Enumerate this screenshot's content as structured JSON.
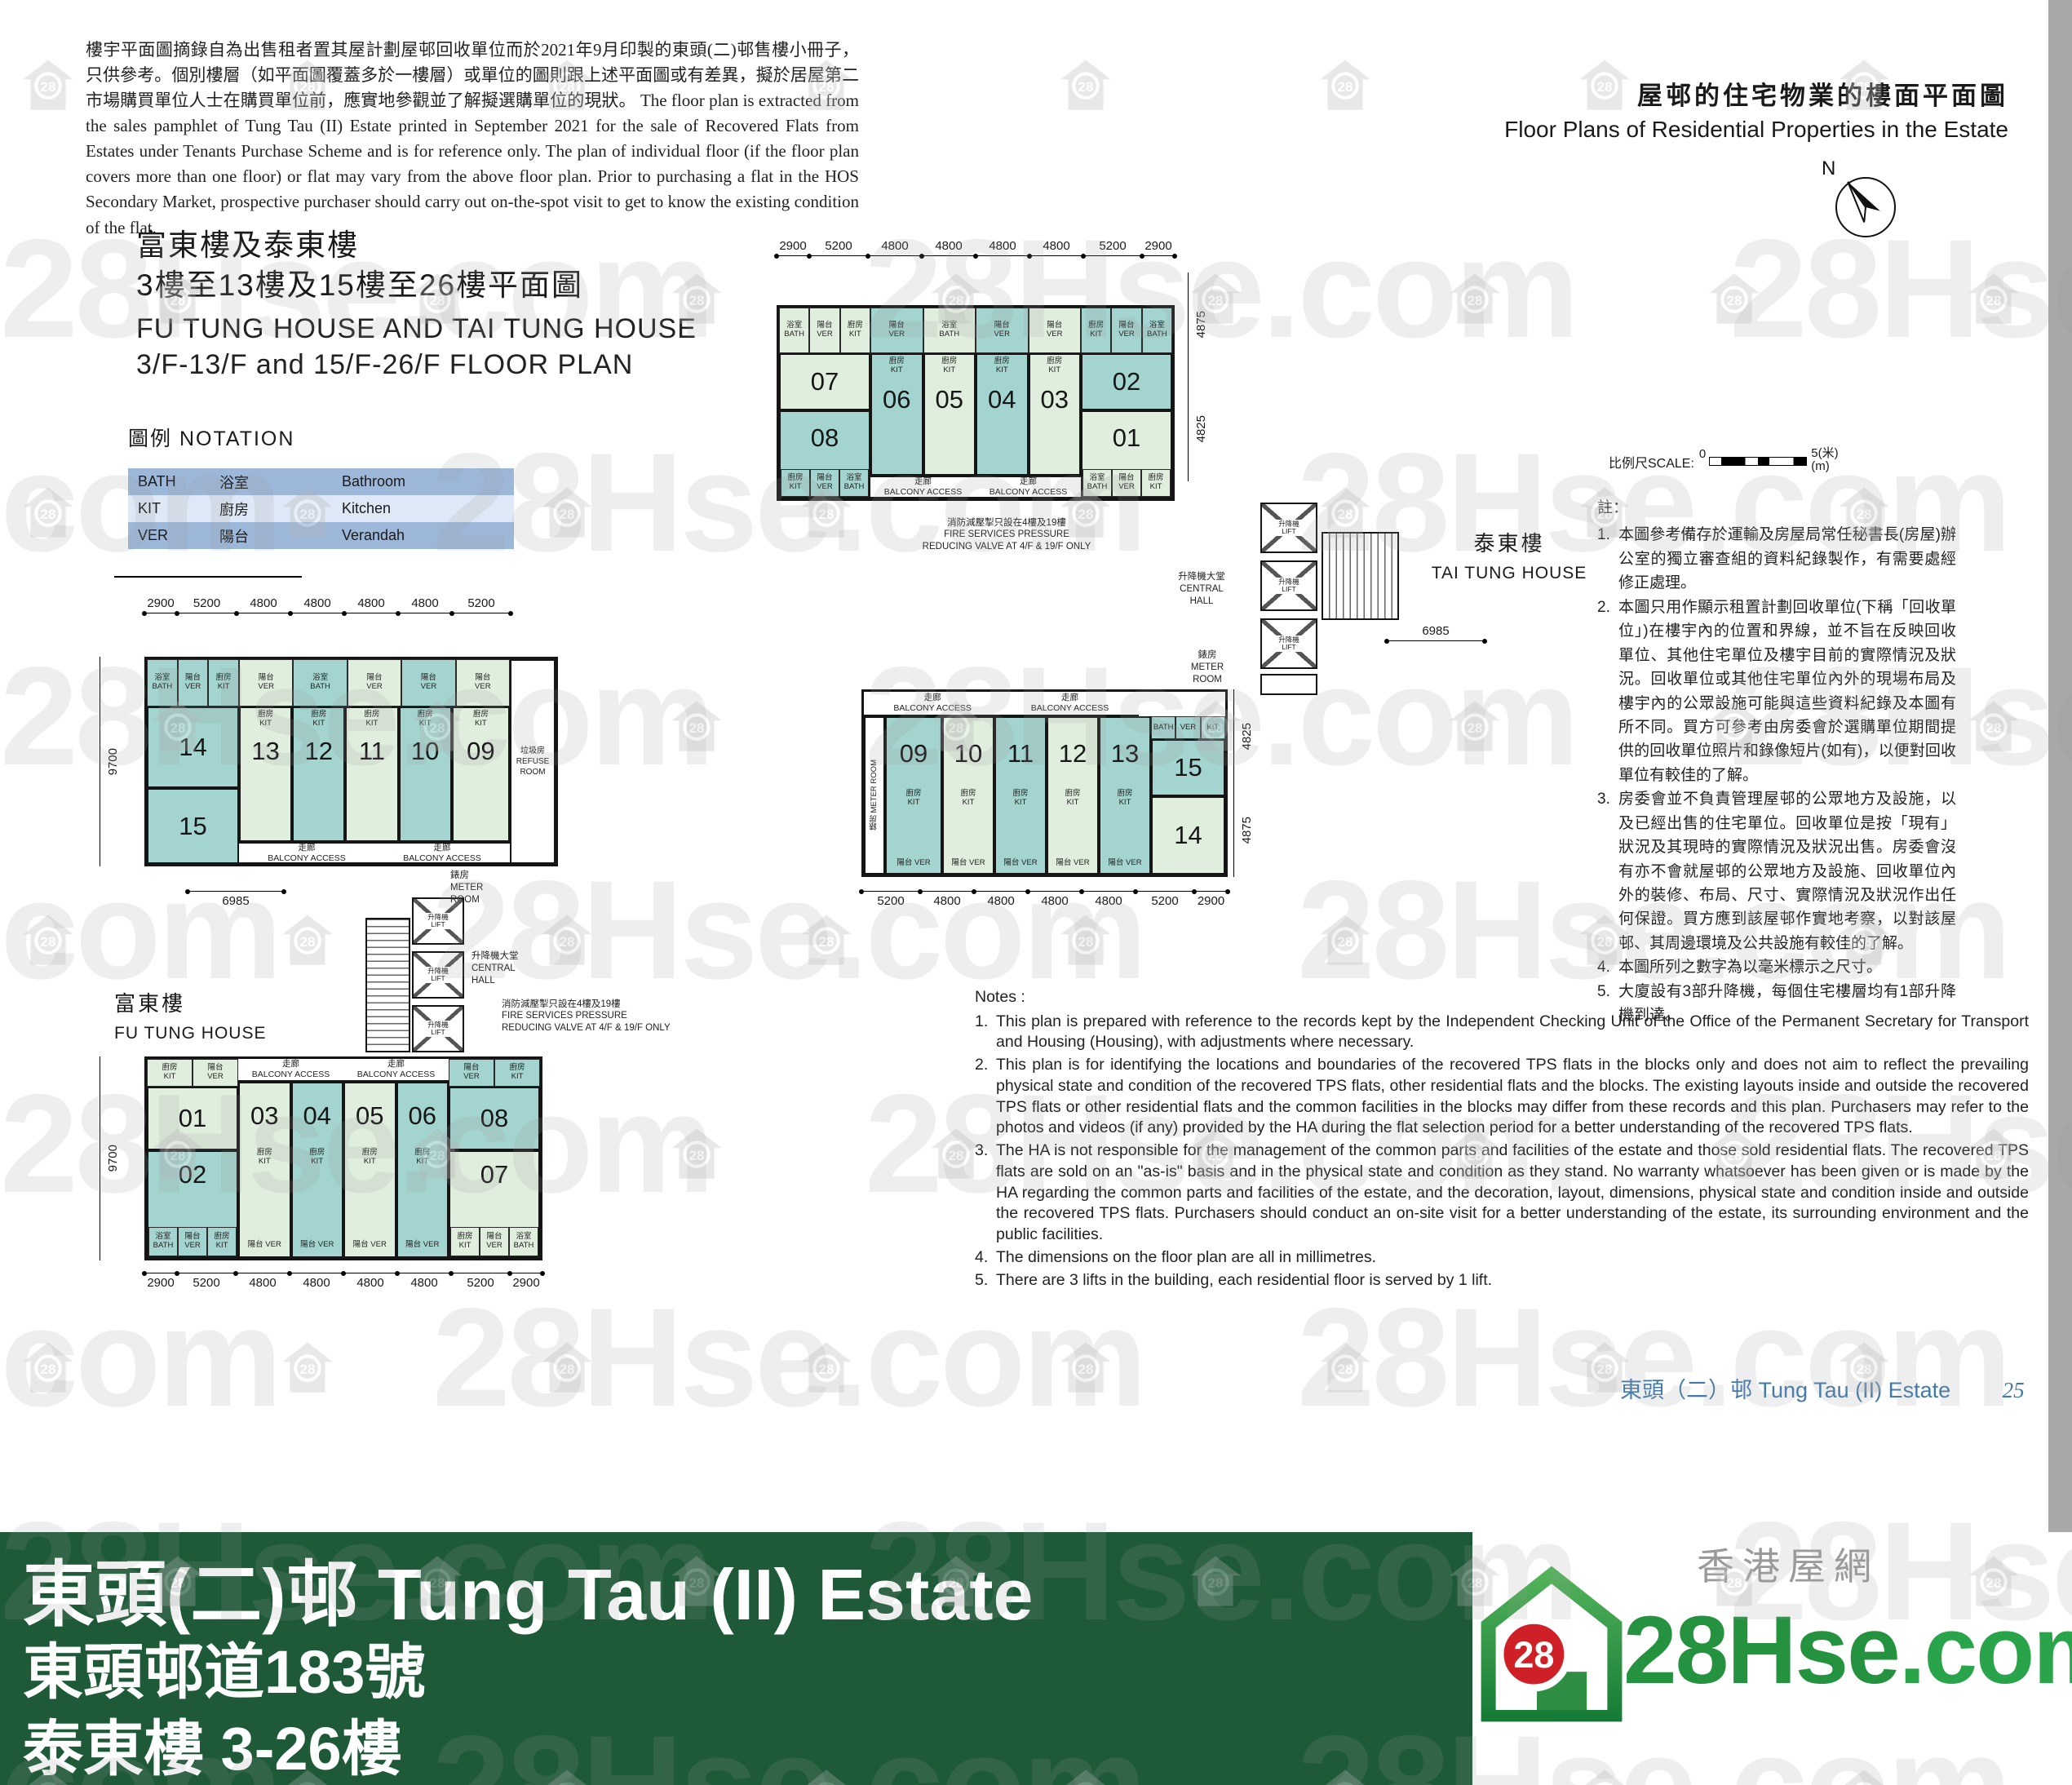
{
  "header": {
    "disclaimer_zh": "樓宇平面圖摘錄自為出售租者置其屋計劃屋邨回收單位而於2021年9月印製的東頭(二)邨售樓小冊子，只供參考。個別樓層（如平面圖覆蓋多於一樓層）或單位的圖則跟上述平面圖或有差異，擬於居屋第二市場購買單位人士在購買單位前，應實地參觀並了解擬選購單位的現狀。",
    "disclaimer_en": "The floor plan is extracted from the sales pamphlet of Tung Tau (II) Estate printed in September 2021 for the sale of Recovered Flats from Estates under Tenants Purchase Scheme and is for reference only.  The plan of individual floor (if the floor plan covers more than one floor) or flat may vary from the above floor plan.  Prior to purchasing a flat in the HOS Secondary Market, prospective purchaser should carry out on-the-spot visit to get to know the existing condition of the flat.",
    "corner_title_zh": "屋邨的住宅物業的樓面平面圖",
    "corner_title_en": "Floor Plans of Residential Properties in the Estate"
  },
  "title": {
    "zh1": "富東樓及泰東樓",
    "zh2": "3樓至13樓及15樓至26樓平面圖",
    "en1": "FU TUNG HOUSE AND TAI TUNG HOUSE",
    "en2": "3/F-13/F and 15/F-26/F FLOOR PLAN"
  },
  "notation": {
    "title_zh": "圖例",
    "title_en": "NOTATION",
    "rows": [
      {
        "code": "BATH",
        "zh": "浴室",
        "en": "Bathroom"
      },
      {
        "code": "KIT",
        "zh": "廚房",
        "en": "Kitchen"
      },
      {
        "code": "VER",
        "zh": "陽台",
        "en": "Verandah"
      }
    ]
  },
  "compass": {
    "north": "N"
  },
  "scalebar": {
    "label": "比例尺SCALE:",
    "start": "0",
    "end": "5",
    "unit_zh": "(米)",
    "unit_en": "(m)"
  },
  "rooms": {
    "ver_zh": "陽台",
    "ver_en": "VER",
    "kit_zh": "廚房",
    "kit_en": "KIT",
    "bath_zh": "浴室",
    "bath_en": "BATH"
  },
  "common": {
    "corridor_zh": "走廊",
    "corridor_en": "BALCONY ACCESS",
    "lift_zh": "升降機",
    "lift_en": "LIFT",
    "hall_zh": "升降機大堂",
    "hall_en1": "CENTRAL",
    "hall_en2": "HALL",
    "meter_zh": "錶房",
    "meter_en1": "METER",
    "meter_en2": "ROOM",
    "refuse_zh": "垃圾房",
    "refuse_en1": "REFUSE",
    "refuse_en2": "ROOM",
    "fire_zh": "消防減壓掣只設在4樓及19樓",
    "fire_en1": "FIRE SERVICES PRESSURE",
    "fire_en2": "REDUCING VALVE AT 4/F & 19/F ONLY"
  },
  "buildings": {
    "tai_tung": {
      "zh": "泰東樓",
      "en": "TAI TUNG HOUSE"
    },
    "fu_tung": {
      "zh": "富東樓",
      "en": "FU TUNG HOUSE"
    }
  },
  "plans": {
    "top": {
      "units": [
        "07",
        "08",
        "06",
        "05",
        "04",
        "03",
        "02",
        "01"
      ],
      "dims_top": [
        "2900",
        "5200",
        "4800",
        "4800",
        "4800",
        "4800",
        "5200",
        "2900"
      ],
      "dims_right": [
        "4875",
        "4825"
      ]
    },
    "left": {
      "units": [
        "14",
        "15",
        "13",
        "12",
        "11",
        "10",
        "09"
      ],
      "dims_top": [
        "2900",
        "5200",
        "4800",
        "4800",
        "4800",
        "4800",
        "5200"
      ],
      "dim_left": "9700",
      "dim_aux": "6985"
    },
    "right": {
      "units": [
        "09",
        "10",
        "11",
        "12",
        "13",
        "15",
        "14"
      ],
      "dims_bottom": [
        "5200",
        "4800",
        "4800",
        "4800",
        "4800",
        "5200",
        "2900"
      ],
      "dims_right": [
        "4825",
        "4875"
      ],
      "dim_aux": "6985"
    },
    "bottom": {
      "units": [
        "01",
        "02",
        "03",
        "04",
        "05",
        "06",
        "08",
        "07"
      ],
      "dims_bottom": [
        "2900",
        "5200",
        "4800",
        "4800",
        "4800",
        "4800",
        "5200",
        "2900"
      ],
      "dim_left": "9700"
    }
  },
  "notes_zh": {
    "heading": "註：",
    "items": [
      "本圖參考備存於運輸及房屋局常任秘書長(房屋)辦公室的獨立審查組的資料紀錄製作，有需要處經修正處理。",
      "本圖只用作顯示租置計劃回收單位(下稱「回收單位」)在樓宇內的位置和界線，並不旨在反映回收單位、其他住宅單位及樓宇目前的實際情況及狀況。回收單位或其他住宅單位內外的現場布局及樓宇內的公眾設施可能與這些資料紀錄及本圖有所不同。買方可參考由房委會於選購單位期間提供的回收單位照片和錄像短片(如有)，以便對回收單位有較佳的了解。",
      "房委會並不負責管理屋邨的公眾地方及設施，以及已經出售的住宅單位。回收單位是按「現有」狀況及其現時的實際情況及狀況出售。房委會沒有亦不會就屋邨的公眾地方及設施、回收單位內外的裝修、布局、尺寸、實際情況及狀況作出任何保證。買方應到該屋邨作實地考察，以對該屋邨、其周邊環境及公共設施有較佳的了解。",
      "本圖所列之數字為以毫米標示之尺寸。",
      "大廈設有3部升降機，每個住宅樓層均有1部升降機到達。"
    ]
  },
  "notes_en": {
    "heading": "Notes :",
    "items": [
      "This plan is prepared with reference to the records kept by the Independent Checking Unit of the Office of the Permanent Secretary for Transport and Housing (Housing), with adjustments where necessary.",
      "This plan is for identifying the locations and boundaries of the recovered TPS flats in the blocks only and does not aim to reflect the prevailing physical state and condition of the recovered TPS flats, other residential flats and the blocks. The existing layouts inside and outside the recovered TPS flats or other residential flats and the common facilities in the blocks may differ from these records and this plan. Purchasers may refer to the photos and videos (if any) provided by the HA during the flat selection period for a better understanding of the recovered TPS flats.",
      "The HA is not responsible for the management of the common parts and facilities of the estate and those sold residential flats. The recovered TPS flats are sold on an \"as-is\" basis and in the physical state and condition as they stand. No warranty whatsoever has been given or is made by the HA regarding the common parts and facilities of the estate, and the decoration, layout, dimensions, physical state and condition inside and outside the recovered TPS flats. Purchasers should conduct an on-site visit for a better understanding of the estate, its surrounding environment and the public facilities.",
      "The dimensions on the floor plan are all in millimetres.",
      "There are 3 lifts in the building, each residential floor is served by 1 lift."
    ]
  },
  "footer": {
    "estate_zh": "東頭（二）邨",
    "estate_en": "Tung Tau (II) Estate",
    "page_no": "25"
  },
  "banner": {
    "line1": "東頭(二)邨 Tung Tau (II) Estate",
    "line2": "東頭邨道183號",
    "line3": "泰東樓 3-26樓"
  },
  "logo": {
    "badge": "28",
    "brand": "28Hse",
    "suffix": ".com",
    "tagline": "香港屋網"
  },
  "watermark": {
    "text": "28Hse.com",
    "badge": "28"
  },
  "colors": {
    "unit_green": "#e0eedd",
    "unit_teal": "#a3d4d0",
    "banner_green": "#1e5a38",
    "footer_blue": "#4179ad",
    "notation_dark": "#9db7d9",
    "notation_light": "#dfe8f6",
    "logo_green": "#24923f",
    "badge_red": "#cf2027"
  }
}
